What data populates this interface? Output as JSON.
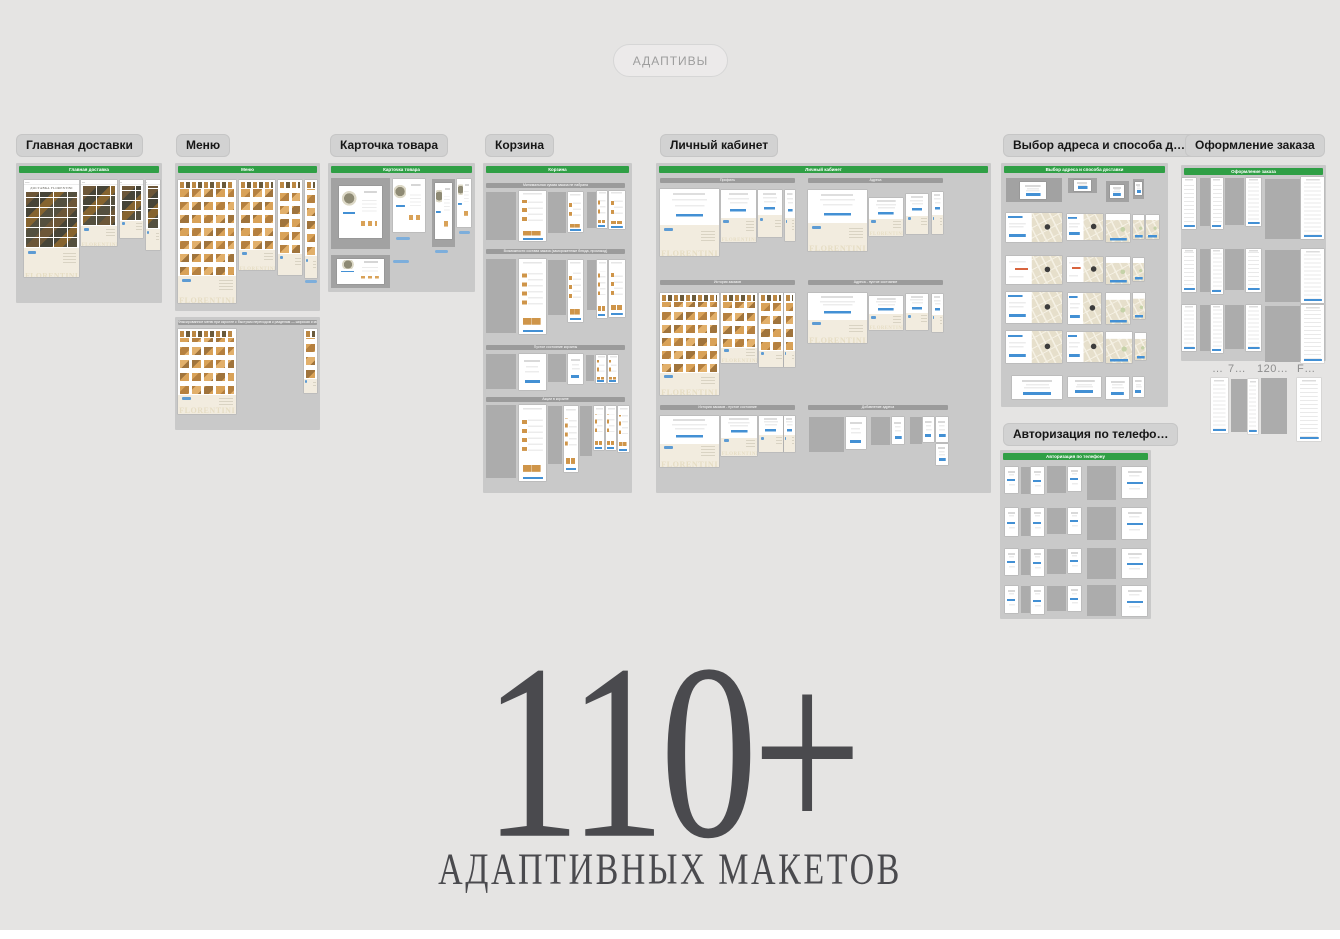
{
  "toolbar": {
    "adaptives_label": "АДАПТИВЫ"
  },
  "brand": {
    "logo": "FLORENTINI",
    "delivery_title": "ДОСТАВКА FLORENTINI"
  },
  "hero": {
    "count": "110+",
    "caption": "АДАПТИВНЫХ МАКЕТОВ"
  },
  "colors": {
    "accent_green": "#2f9f45",
    "accent_blue": "#4390d4",
    "canvas": "#e5e4e3"
  },
  "sections": [
    {
      "chip": "Главная доставки",
      "frame_title": "Главная доставка"
    },
    {
      "chip": "Меню",
      "frame_title": "Меню",
      "subframe_title": "Фиксированное меню при скролле с быстрым переходом к разделам — широкая и мобильная версии"
    },
    {
      "chip": "Карточка товара",
      "frame_title": "Карточка товара"
    },
    {
      "chip": "Корзина",
      "frame_title": "Корзина",
      "subsections": [
        "Минимальная сумма заказа не набрана",
        "Возможности состава заказа (замороженные блюда, промокод)",
        "Пустое состояние корзины",
        "Акции в корзине"
      ]
    },
    {
      "chip": "Личный кабинет",
      "frame_title": "Личный кабинет",
      "subsections": [
        "Профиль",
        "Адреса",
        "История заказов",
        "Адреса - пустое состояние",
        "История заказов - пустое состояние",
        "Добавление адреса"
      ]
    },
    {
      "chip": "Выбор адреса и способа д…",
      "frame_title": "Выбор адреса и способа доставки"
    },
    {
      "chip": "Оформление заказа",
      "frame_title": "Оформление заказа"
    },
    {
      "chip": "Авторизация по телефо…",
      "frame_title": "Авторизация по телефону"
    }
  ],
  "loose_frames": {
    "labels": [
      "…",
      "7…",
      "120…",
      "F…"
    ]
  }
}
